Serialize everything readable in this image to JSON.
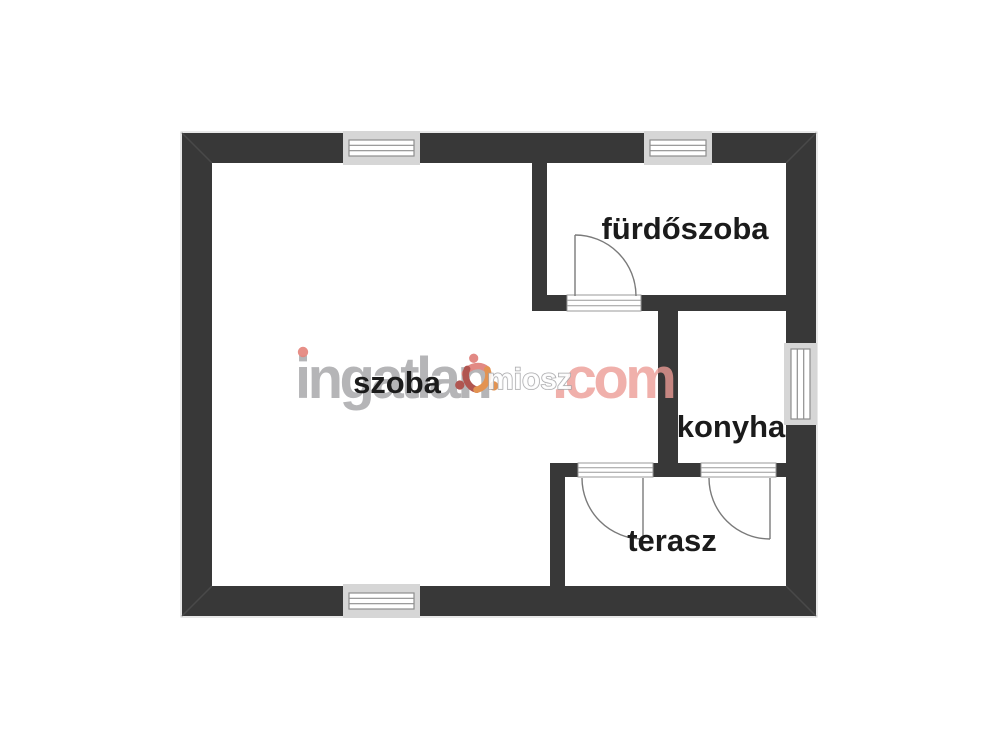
{
  "watermark": {
    "brand": "ingatlan",
    "suffix": ".com",
    "logo_text": "miosz",
    "colors": {
      "brand_gray": "#9b9b9e",
      "suffix_red": "#ec9b94",
      "i_dot_red": "#e2776f"
    }
  },
  "rooms": {
    "szoba": {
      "label": "szoba"
    },
    "furdoszoba": {
      "label": "fürdőszoba"
    },
    "konyha": {
      "label": "konyha"
    },
    "terasz": {
      "label": "terasz"
    }
  },
  "plan_symbols": {
    "windows": [
      "szoba-north-window",
      "furdoszoba-north-window",
      "konyha-east-window",
      "szoba-south-window"
    ],
    "doors": [
      "furdoszoba-door",
      "szoba-terasz-door",
      "konyha-terasz-door"
    ]
  },
  "colors": {
    "wall": "#383838",
    "label_text": "#1b1b1b",
    "door_line": "#7a7a7a",
    "window_frame": "#d6d6d6",
    "window_line": "#8e8e8e",
    "background": "#ffffff"
  }
}
